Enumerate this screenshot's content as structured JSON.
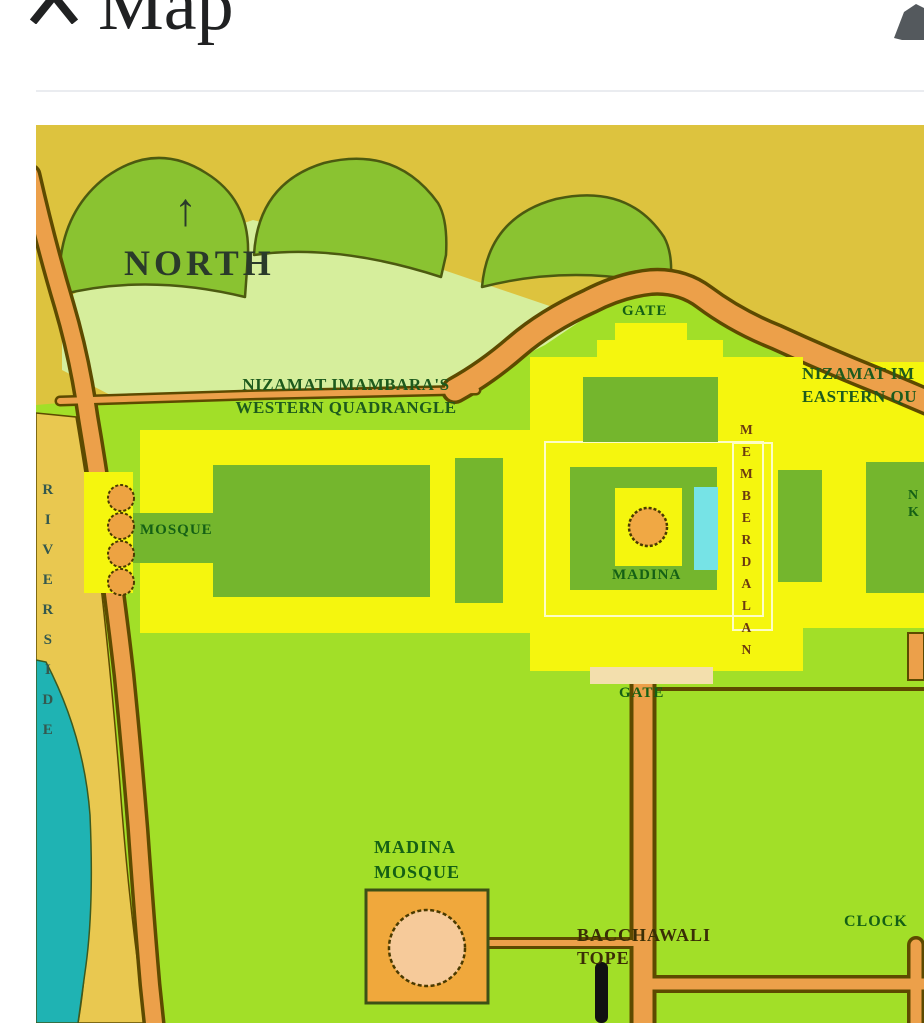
{
  "header": {
    "title": "Map",
    "collapse_icon": "chevron-up",
    "edit_icon": "edit-pencil"
  },
  "map": {
    "labels": {
      "north_arrow": "↑",
      "north": "NORTH",
      "gate_top": "GATE",
      "western_quadrangle_line1": "NIZAMAT IMAMBARA'S",
      "western_quadrangle_line2": "WESTERN QUADRANGLE",
      "eastern_quadrangle_line1": "NIZAMAT IM",
      "eastern_quadrangle_line2": "EASTERN QU",
      "riverside": "RIVERSIDE",
      "mosque": "MOSQUE",
      "madina": "MADINA",
      "memberdalan": "MEMBERDALAN",
      "gate_middle": "GATE",
      "madina_mosque": "MADINA\nMOSQUE",
      "bacchawali_tope": "BACCHAWALI\nTOPE",
      "clock": "CLOCK",
      "n_k": "N\nK"
    },
    "colors": {
      "olive_background": "#ddc33e",
      "ground_green": "#a2df28",
      "pale_field": "#d6ee9c",
      "tree_green": "#8ac331",
      "quadrangle_yellow": "#f5f60e",
      "building_green": "#74b62d",
      "road_orange": "#eca04a",
      "road_outline": "#5d4a00",
      "river_cyan": "#1fb3b3",
      "sand_band": "#e9c850",
      "gate_tan": "#f3dfad",
      "mosque_orange": "#f0a83c",
      "dome_peach": "#f6ca9a",
      "label_green": "#156015"
    }
  }
}
